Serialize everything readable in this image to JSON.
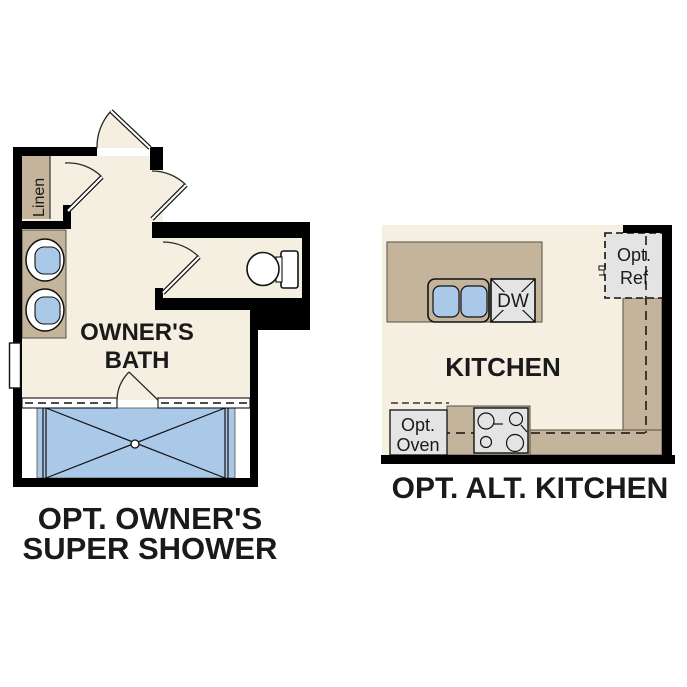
{
  "colors": {
    "floor": "#f5efe2",
    "counter": "#c4b49b",
    "water": "#aac9e8",
    "appliance": "#e4e4e4",
    "wall": "#000000",
    "ink": "#1a1a1a"
  },
  "bath": {
    "linen_label": "Linen",
    "room_label_line1": "OWNER'S",
    "room_label_line2": "BATH",
    "caption_line1": "OPT. OWNER'S",
    "caption_line2": "SUPER SHOWER"
  },
  "kitchen": {
    "room_label": "KITCHEN",
    "dishwasher_label": "DW",
    "fridge_label_line1": "Opt.",
    "fridge_label_line2": "Ref",
    "oven_label_line1": "Opt.",
    "oven_label_line2": "Oven",
    "caption": "OPT. ALT. KITCHEN"
  }
}
